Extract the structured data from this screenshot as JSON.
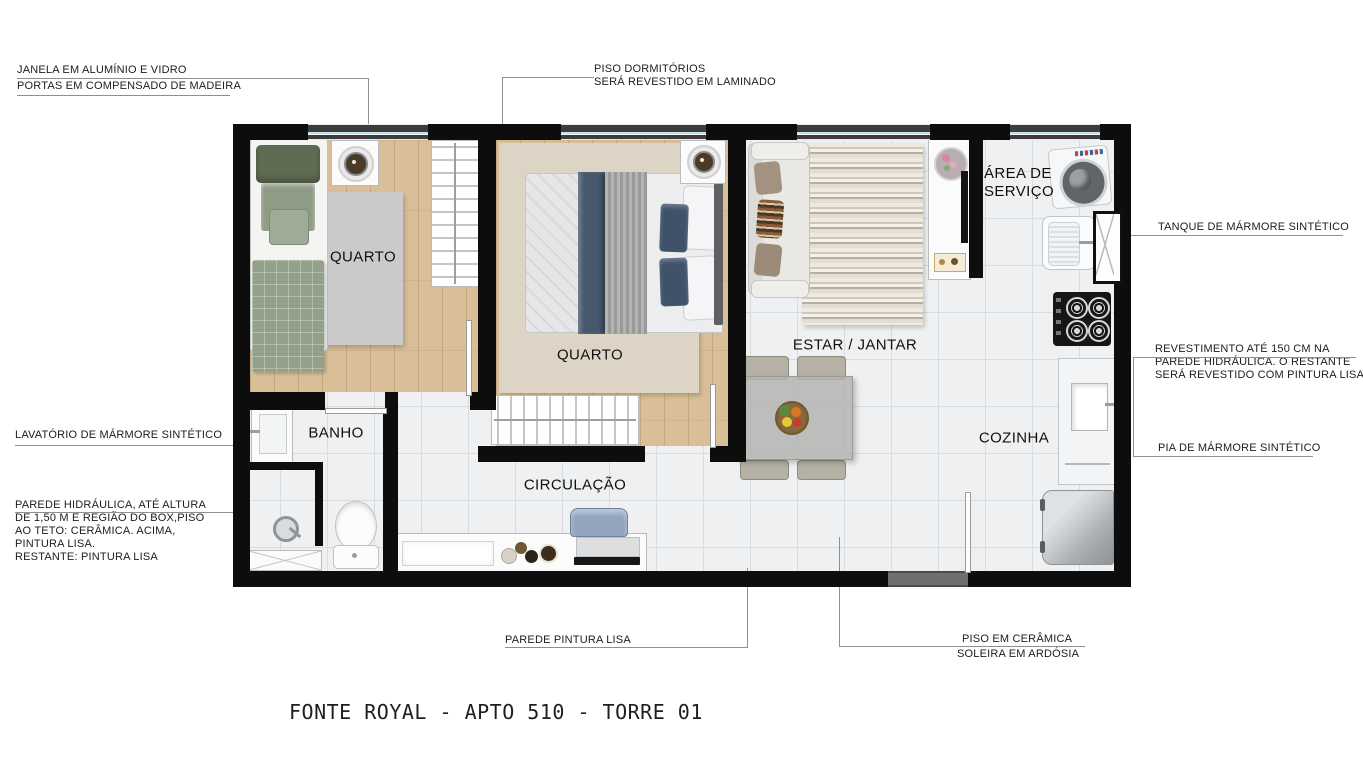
{
  "title": "FONTE ROYAL - APTO 510 - TORRE 01",
  "rooms": {
    "quarto1": "QUARTO",
    "quarto2": "QUARTO",
    "banho": "BANHO",
    "circulacao": "CIRCULAÇÃO",
    "estar_jantar": "ESTAR / JANTAR",
    "area_servico_l1": "ÁREA DE",
    "area_servico_l2": "SERVIÇO",
    "cozinha": "COZINHA"
  },
  "annotations": {
    "janela": "JANELA EM ALUMÍNIO E VIDRO",
    "portas": "PORTAS EM COMPENSADO DE MADEIRA",
    "piso_dorm_l1": "PISO DORMITÓRIOS",
    "piso_dorm_l2": "SERÁ REVESTIDO EM LAMINADO",
    "tanque": "TANQUE DE MÁRMORE SINTÉTICO",
    "revestimento_l1": "REVESTIMENTO ATÉ 150 CM NA",
    "revestimento_l2": "PAREDE HIDRÁULICA. O RESTANTE",
    "revestimento_l3": "SERÁ REVESTIDO COM PINTURA LISA",
    "pia": "PIA DE MÁRMORE SINTÉTICO",
    "lavatorio": "LAVATÓRIO DE MÁRMORE SINTÉTICO",
    "parede_hidr_l1": "PAREDE HIDRÁULICA, ATÉ ALTURA",
    "parede_hidr_l2": "DE 1,50 M E REGIÃO DO BOX,PISO",
    "parede_hidr_l3": "AO TETO: CERÂMICA. ACIMA,",
    "parede_hidr_l4": "PINTURA LISA.",
    "parede_hidr_l5": "RESTANTE: PINTURA LISA",
    "parede_pintura": "PAREDE PINTURA LISA",
    "piso_ceramica_l1": "PISO EM CERÂMICA",
    "piso_ceramica_l2": "SOLEIRA EM ARDÓSIA"
  },
  "colors": {
    "wall": "#0d0d0d",
    "wood_floor": "#d9bf97",
    "tile_floor": "#eef0f1",
    "window_glass": "#bfe2ec",
    "soleira": "#6f6f6f",
    "leader_line": "#8f8f8f",
    "bed1_quilt": "#93a189",
    "bed2_runner": "#46586e",
    "rug_living_tone": "#d9d2c4"
  }
}
